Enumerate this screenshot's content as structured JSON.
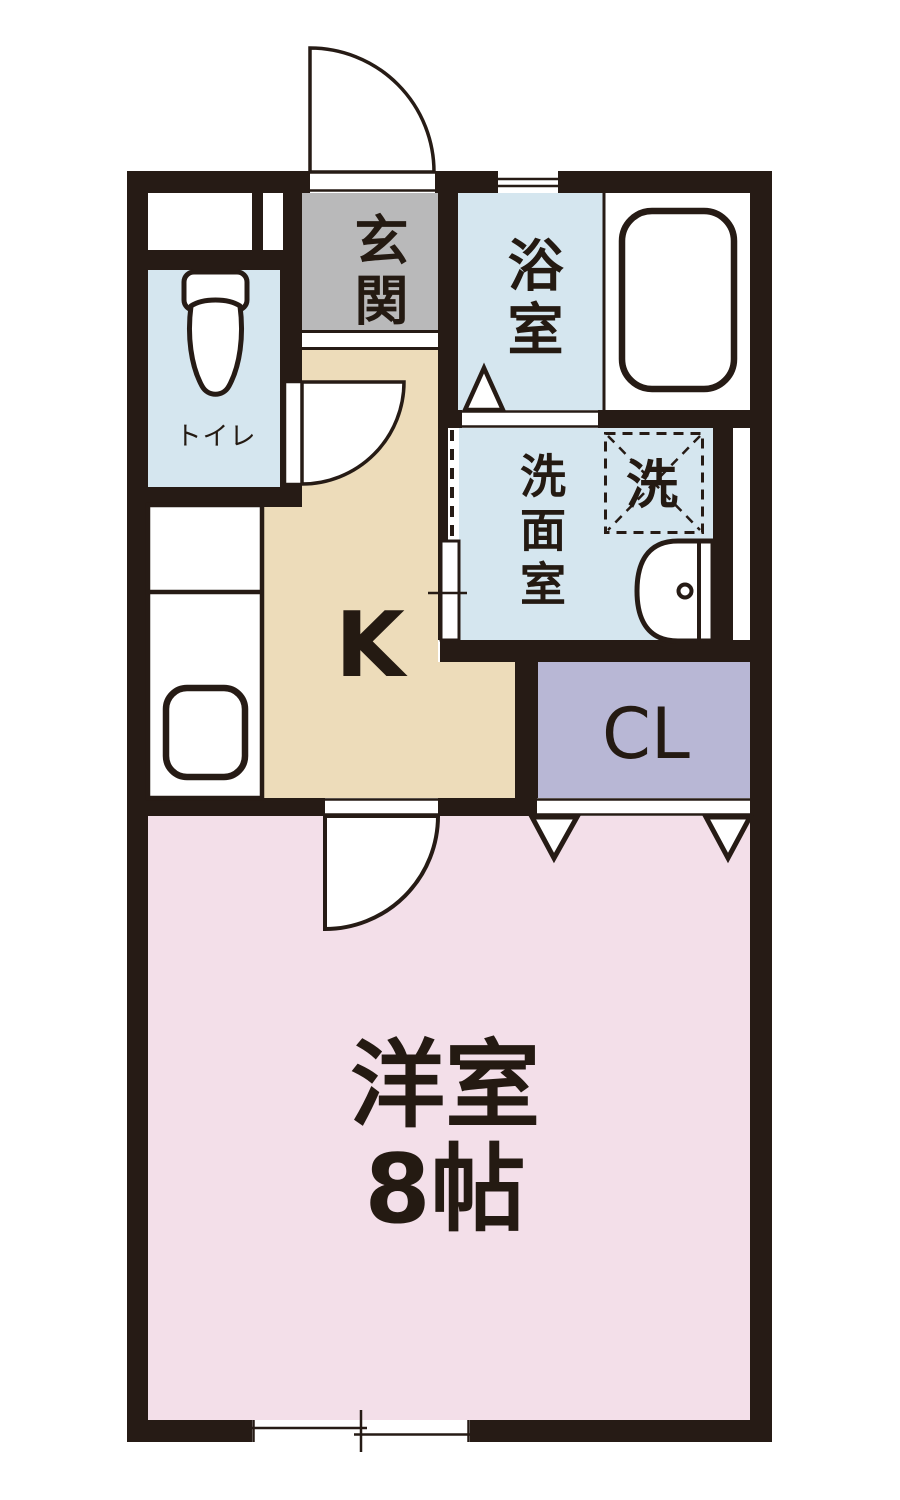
{
  "title": "apartment-floor-plan",
  "rooms": {
    "genkan": {
      "label": "玄関",
      "color": "#b9b9ba"
    },
    "bathroom": {
      "label": "浴室",
      "color": "#d5e6ef"
    },
    "toilet": {
      "label": "トイレ",
      "color": "#d5e6ef"
    },
    "washroom": {
      "label": "洗面室",
      "color": "#d5e6ef"
    },
    "washer_space": {
      "label": "洗"
    },
    "kitchen": {
      "label": "K",
      "color": "#eddcba"
    },
    "closet": {
      "label": "CL",
      "color": "#b8b7d5"
    },
    "western_room": {
      "label": "洋室",
      "size_label": "8帖",
      "color": "#f3dfe9"
    }
  },
  "colors": {
    "wall": "#261b15",
    "outline": "#261b15",
    "water_area_blue": "#d5e6ef",
    "genkan_gray": "#b9b9ba",
    "kitchen_beige": "#eddcba",
    "closet_purple": "#b8b7d5",
    "room_pink": "#f3dfe9",
    "fixture_white": "#ffffff"
  },
  "fixtures": [
    "entrance-door-swing",
    "toilet-icon",
    "bathtub-icon",
    "washbasin-icon",
    "kitchen-counter",
    "kitchen-sink",
    "washing-machine-space",
    "bathroom-folding-door",
    "washroom-sliding-door",
    "toilet-door-swing",
    "room-door-swing",
    "closet-folding-door",
    "top-window",
    "bottom-sliding-window"
  ]
}
